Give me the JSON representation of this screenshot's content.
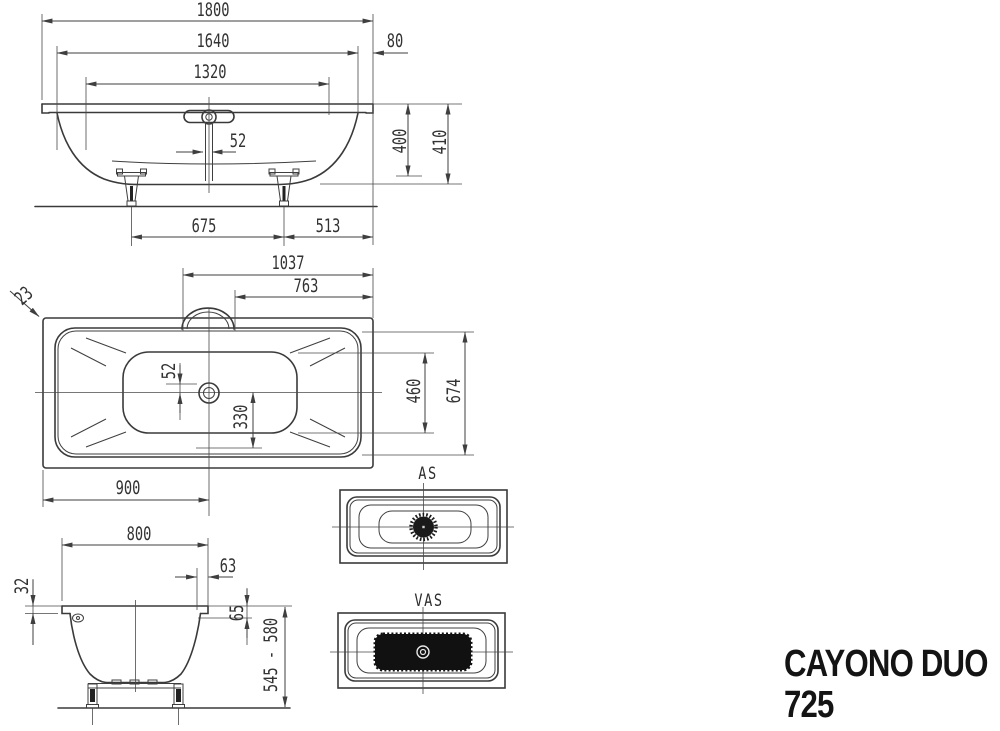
{
  "product": {
    "name": "CAYONO DUO",
    "model": "725"
  },
  "views": {
    "side_elevation": {
      "dims": {
        "total_length": "1800",
        "inner_length": "1640",
        "end_rim": "80",
        "bottom_length": "1320",
        "drain_offset": "52",
        "inner_depth": "400",
        "total_depth": "410",
        "feet_spacing": "675",
        "feet_to_end": "513"
      }
    },
    "plan": {
      "dims": {
        "drain_to_end": "1037",
        "overflow_to_end": "763",
        "rim_edge": "23",
        "drain_cross_offset": "52",
        "drain_lateral": "330",
        "center_to_end": "900",
        "base_width": "460",
        "inner_width": "674"
      }
    },
    "end_elevation": {
      "dims": {
        "overall_width": "800",
        "edge_offset": "63",
        "rim_drop": "32",
        "inner_edge_drop": "65",
        "height_range": "545 - 580"
      }
    },
    "as_view": {
      "label": "AS"
    },
    "vas_view": {
      "label": "VAS"
    }
  }
}
